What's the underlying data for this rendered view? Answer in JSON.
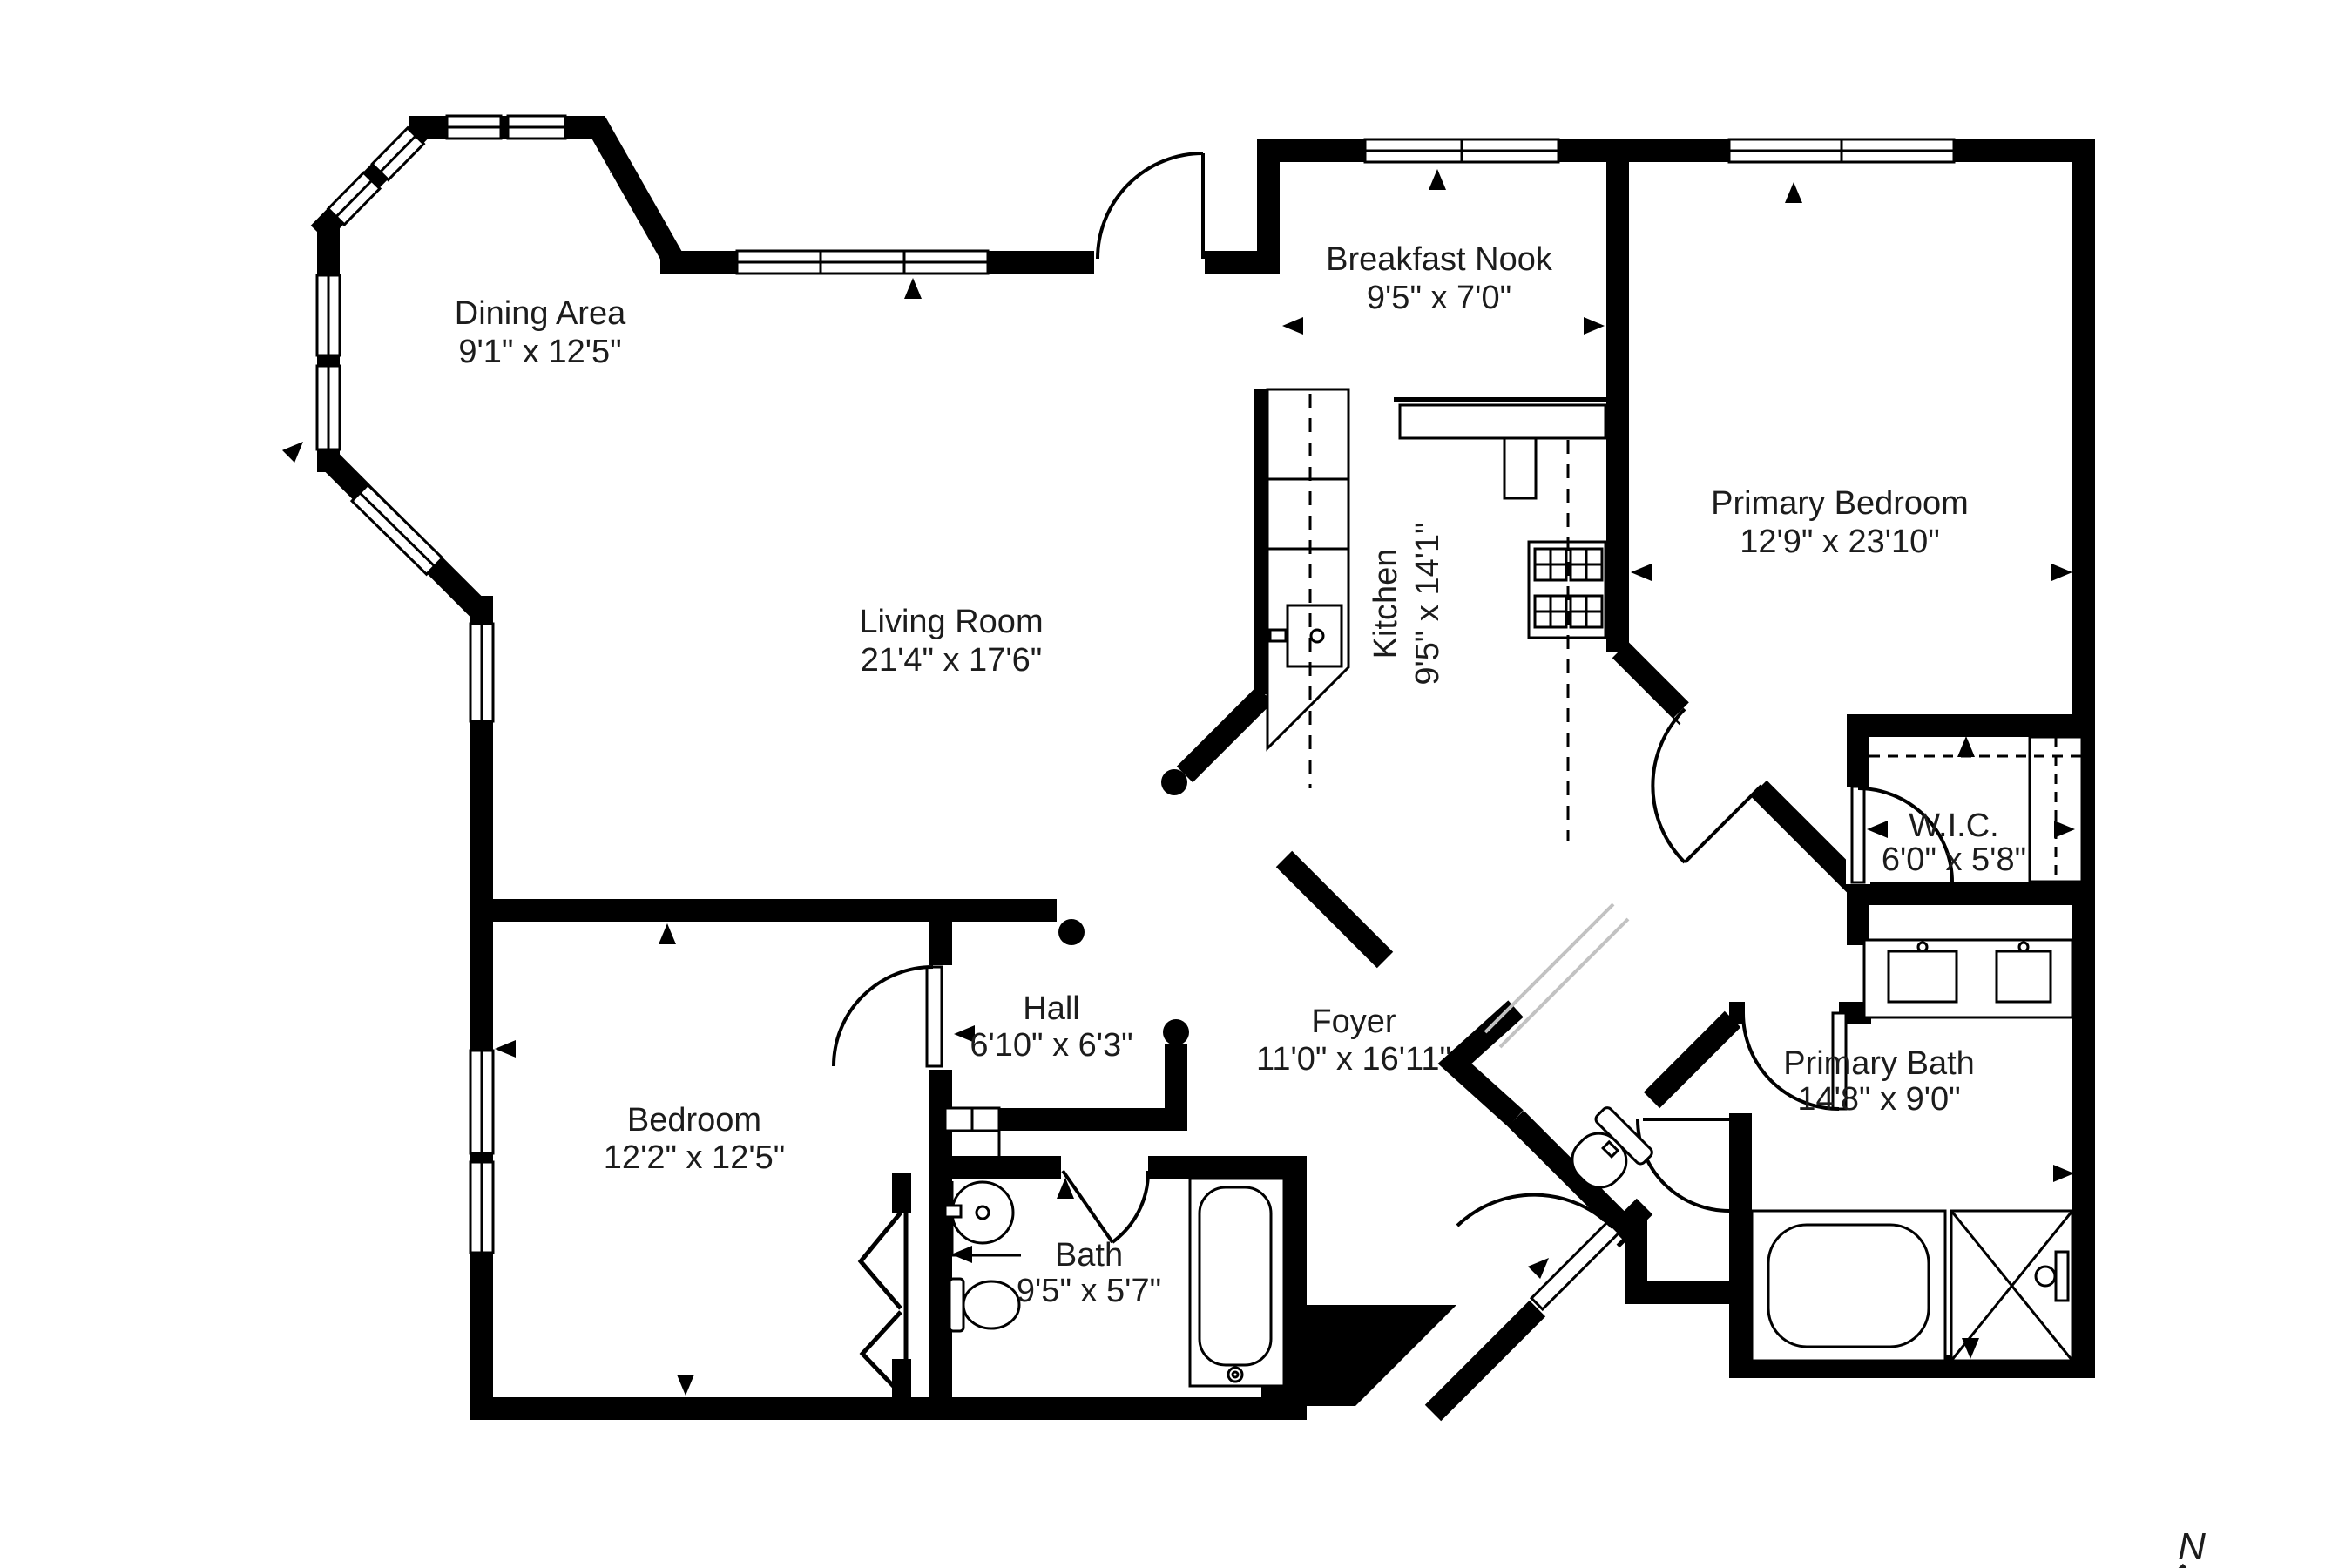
{
  "plan": {
    "type": "floor-plan",
    "colors": {
      "wall": "#000000",
      "text": "#1c1c1c",
      "background": "#ffffff",
      "threshold": "#c2c2c2"
    },
    "compass": {
      "label": "N"
    },
    "rooms": [
      {
        "id": "dining-area",
        "name": "Dining Area",
        "dims": "9'1\" x 12'5\""
      },
      {
        "id": "breakfast-nook",
        "name": "Breakfast Nook",
        "dims": "9'5\" x 7'0\""
      },
      {
        "id": "primary-bedroom",
        "name": "Primary Bedroom",
        "dims": "12'9\" x 23'10\""
      },
      {
        "id": "living-room",
        "name": "Living Room",
        "dims": "21'4\" x 17'6\""
      },
      {
        "id": "kitchen",
        "name": "Kitchen",
        "dims": "9'5\" x 14'1\""
      },
      {
        "id": "wic",
        "name": "W.I.C.",
        "dims": "6'0\" x 5'8\""
      },
      {
        "id": "hall",
        "name": "Hall",
        "dims": "6'10\" x 6'3\""
      },
      {
        "id": "foyer",
        "name": "Foyer",
        "dims": "11'0\" x 16'11\""
      },
      {
        "id": "primary-bath",
        "name": "Primary Bath",
        "dims": "14'8\" x 9'0\""
      },
      {
        "id": "bedroom",
        "name": "Bedroom",
        "dims": "12'2\" x 12'5\""
      },
      {
        "id": "bath",
        "name": "Bath",
        "dims": "9'5\" x 5'7\""
      }
    ]
  }
}
